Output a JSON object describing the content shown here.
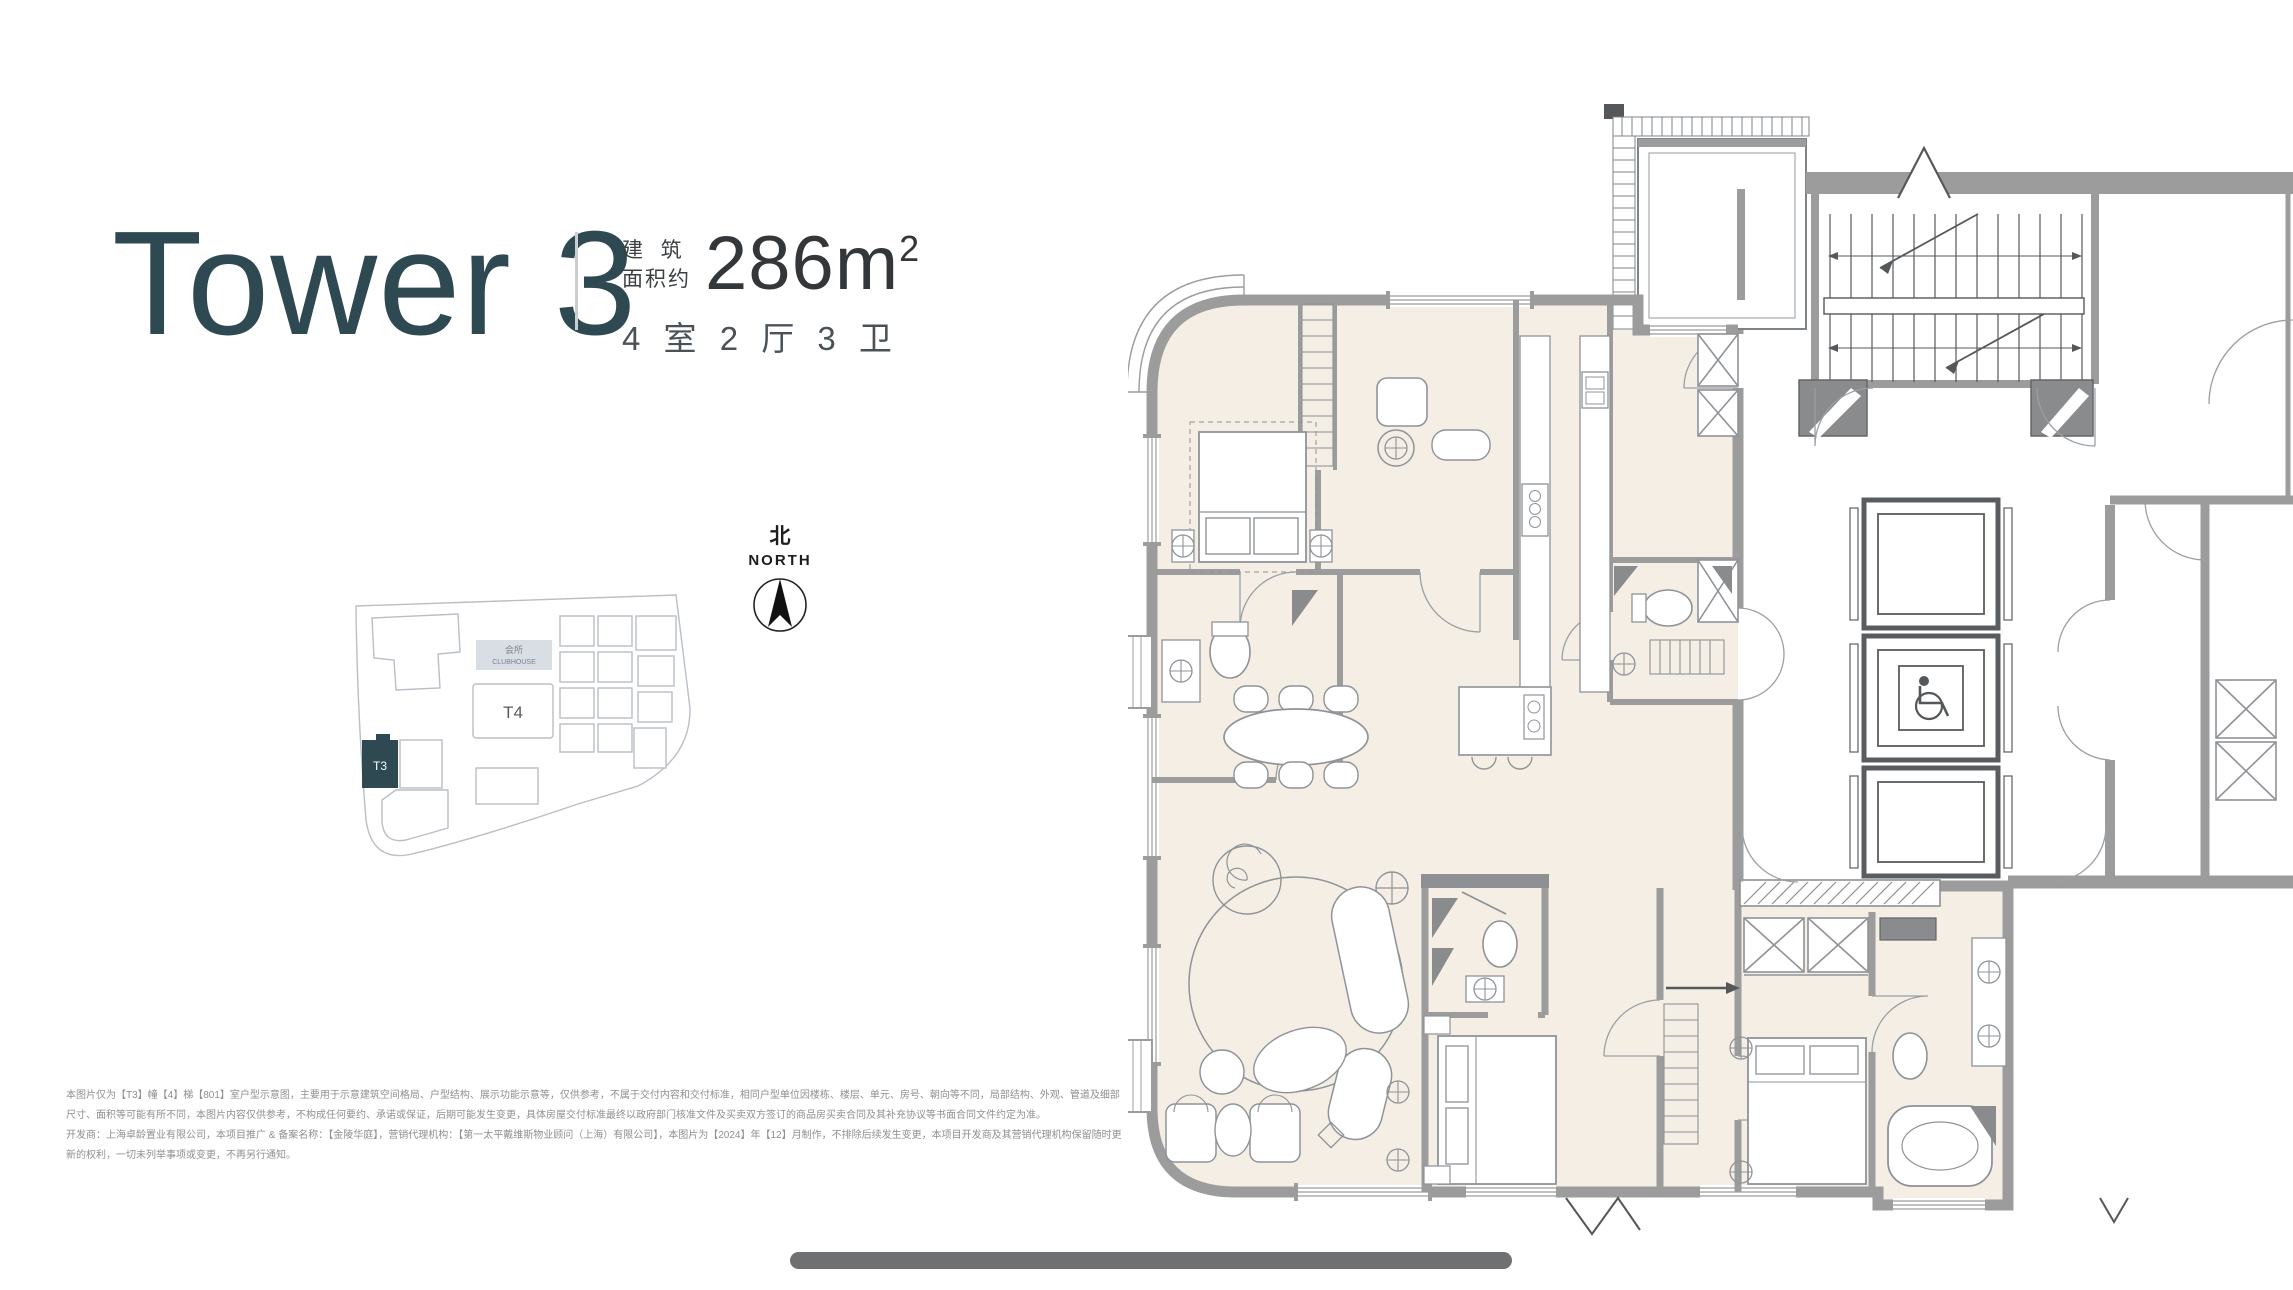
{
  "header": {
    "title": "Tower 3",
    "area_label_top": "建  筑",
    "area_label_bottom": "面积约",
    "area_value": "286",
    "area_unit_base": "m",
    "area_unit_sup": "2",
    "layout_text": "4 室 2 厅 3 卫"
  },
  "compass": {
    "zh": "北",
    "en": "NORTH"
  },
  "site_plan": {
    "clubhouse_zh": "会所",
    "clubhouse_en": "CLUBHOUSE",
    "tower_t4": "T4",
    "tower_t3": "T3"
  },
  "disclaimer": {
    "paragraphs": [
      "本图片仅为【T3】幢【4】梯【801】室户型示意图，主要用于示意建筑空间格局、户型结构、展示功能示意等，仅供参考，不属于交付内容和交付标准，相同户型单位因楼栋、楼层、单元、房号、朝向等不同，局部结构、外观、管道及细部尺寸、面积等可能有所不同，本图片内容仅供参考，不构成任何要约、承诺或保证，后期可能发生变更，具体房屋交付标准最终以政府部门核准文件及买卖双方签订的商品房买卖合同及其补充协议等书面合同文件约定为准。",
      "开发商：上海卓龄置业有限公司，本项目推广 & 备案名称：【金陵华庭】，营销代理机构：【第一太平戴维斯物业顾问（上海）有限公司】，本图片为【2024】年【12】月制作，不排除后续发生变更，本项目开发商及其营销代理机构保留随时更新的权利，一切未列举事项或变更，不再另行通知。"
    ]
  },
  "colors": {
    "accent_teal": "#2e4952",
    "floor_beige": "#f4eee5",
    "wall_gray": "#9c9c9c",
    "bar_gray": "#6f7071"
  }
}
